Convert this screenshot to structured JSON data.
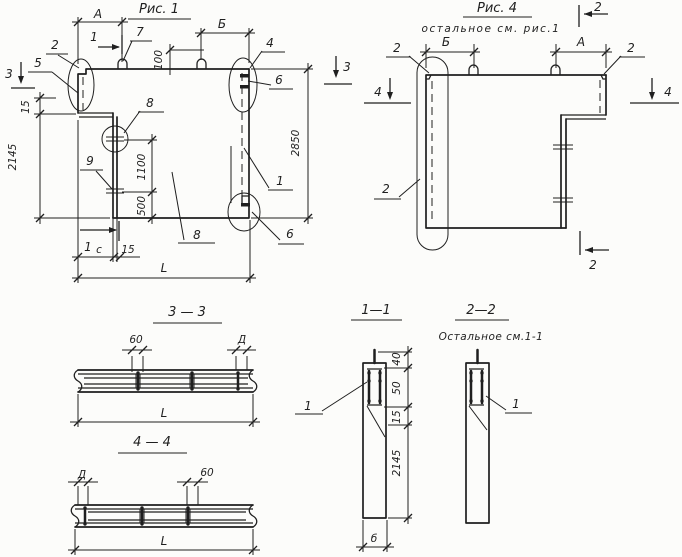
{
  "colors": {
    "ink": "#1f1f1f",
    "paper": "#fcfcfa"
  },
  "fig1": {
    "title": "Рис. 1",
    "dims": {
      "a": "А",
      "b": "Б",
      "h100": "100",
      "v15_left": "15",
      "v2145": "2145",
      "v2850": "2850",
      "v1100": "1100",
      "v500": "500",
      "c": "с",
      "b15": "15",
      "l": "L"
    },
    "positions": {
      "p1": "1",
      "p2": "2",
      "p4": "4",
      "p5": "5",
      "p6_top": "6",
      "p6_bottom": "6",
      "p7": "7",
      "p8_detail": "8",
      "p8_face": "8",
      "p9": "9"
    },
    "section_marks": {
      "s1_top": "1",
      "s1_bottom": "1",
      "s3_left": "3",
      "s3_right": "3"
    }
  },
  "fig4": {
    "title": "Рис. 4",
    "subtitle": "остальное  см. рис.1",
    "dims": {
      "a": "А",
      "b": "Б"
    },
    "positions": {
      "p2_top_left": "2",
      "p2_top_right": "2",
      "p2_side": "2"
    },
    "section_marks": {
      "s2_top": "2",
      "s2_bottom": "2",
      "s4_left": "4",
      "s4_right": "4"
    }
  },
  "sec33": {
    "title": "3 — 3",
    "dims": {
      "d60": "60",
      "d": "Д",
      "l": "L"
    }
  },
  "sec44": {
    "title": "4 — 4",
    "dims": {
      "d": "Д",
      "d60": "60",
      "l": "L"
    }
  },
  "sec11": {
    "title": "1—1",
    "dims": {
      "d40": "40",
      "d50": "50",
      "d15": "15",
      "d2145": "2145",
      "width": "б"
    },
    "positions": {
      "p1": "1"
    }
  },
  "sec22": {
    "title": "2—2",
    "subtitle": "Остальное см.1-1",
    "positions": {
      "p1": "1"
    }
  }
}
